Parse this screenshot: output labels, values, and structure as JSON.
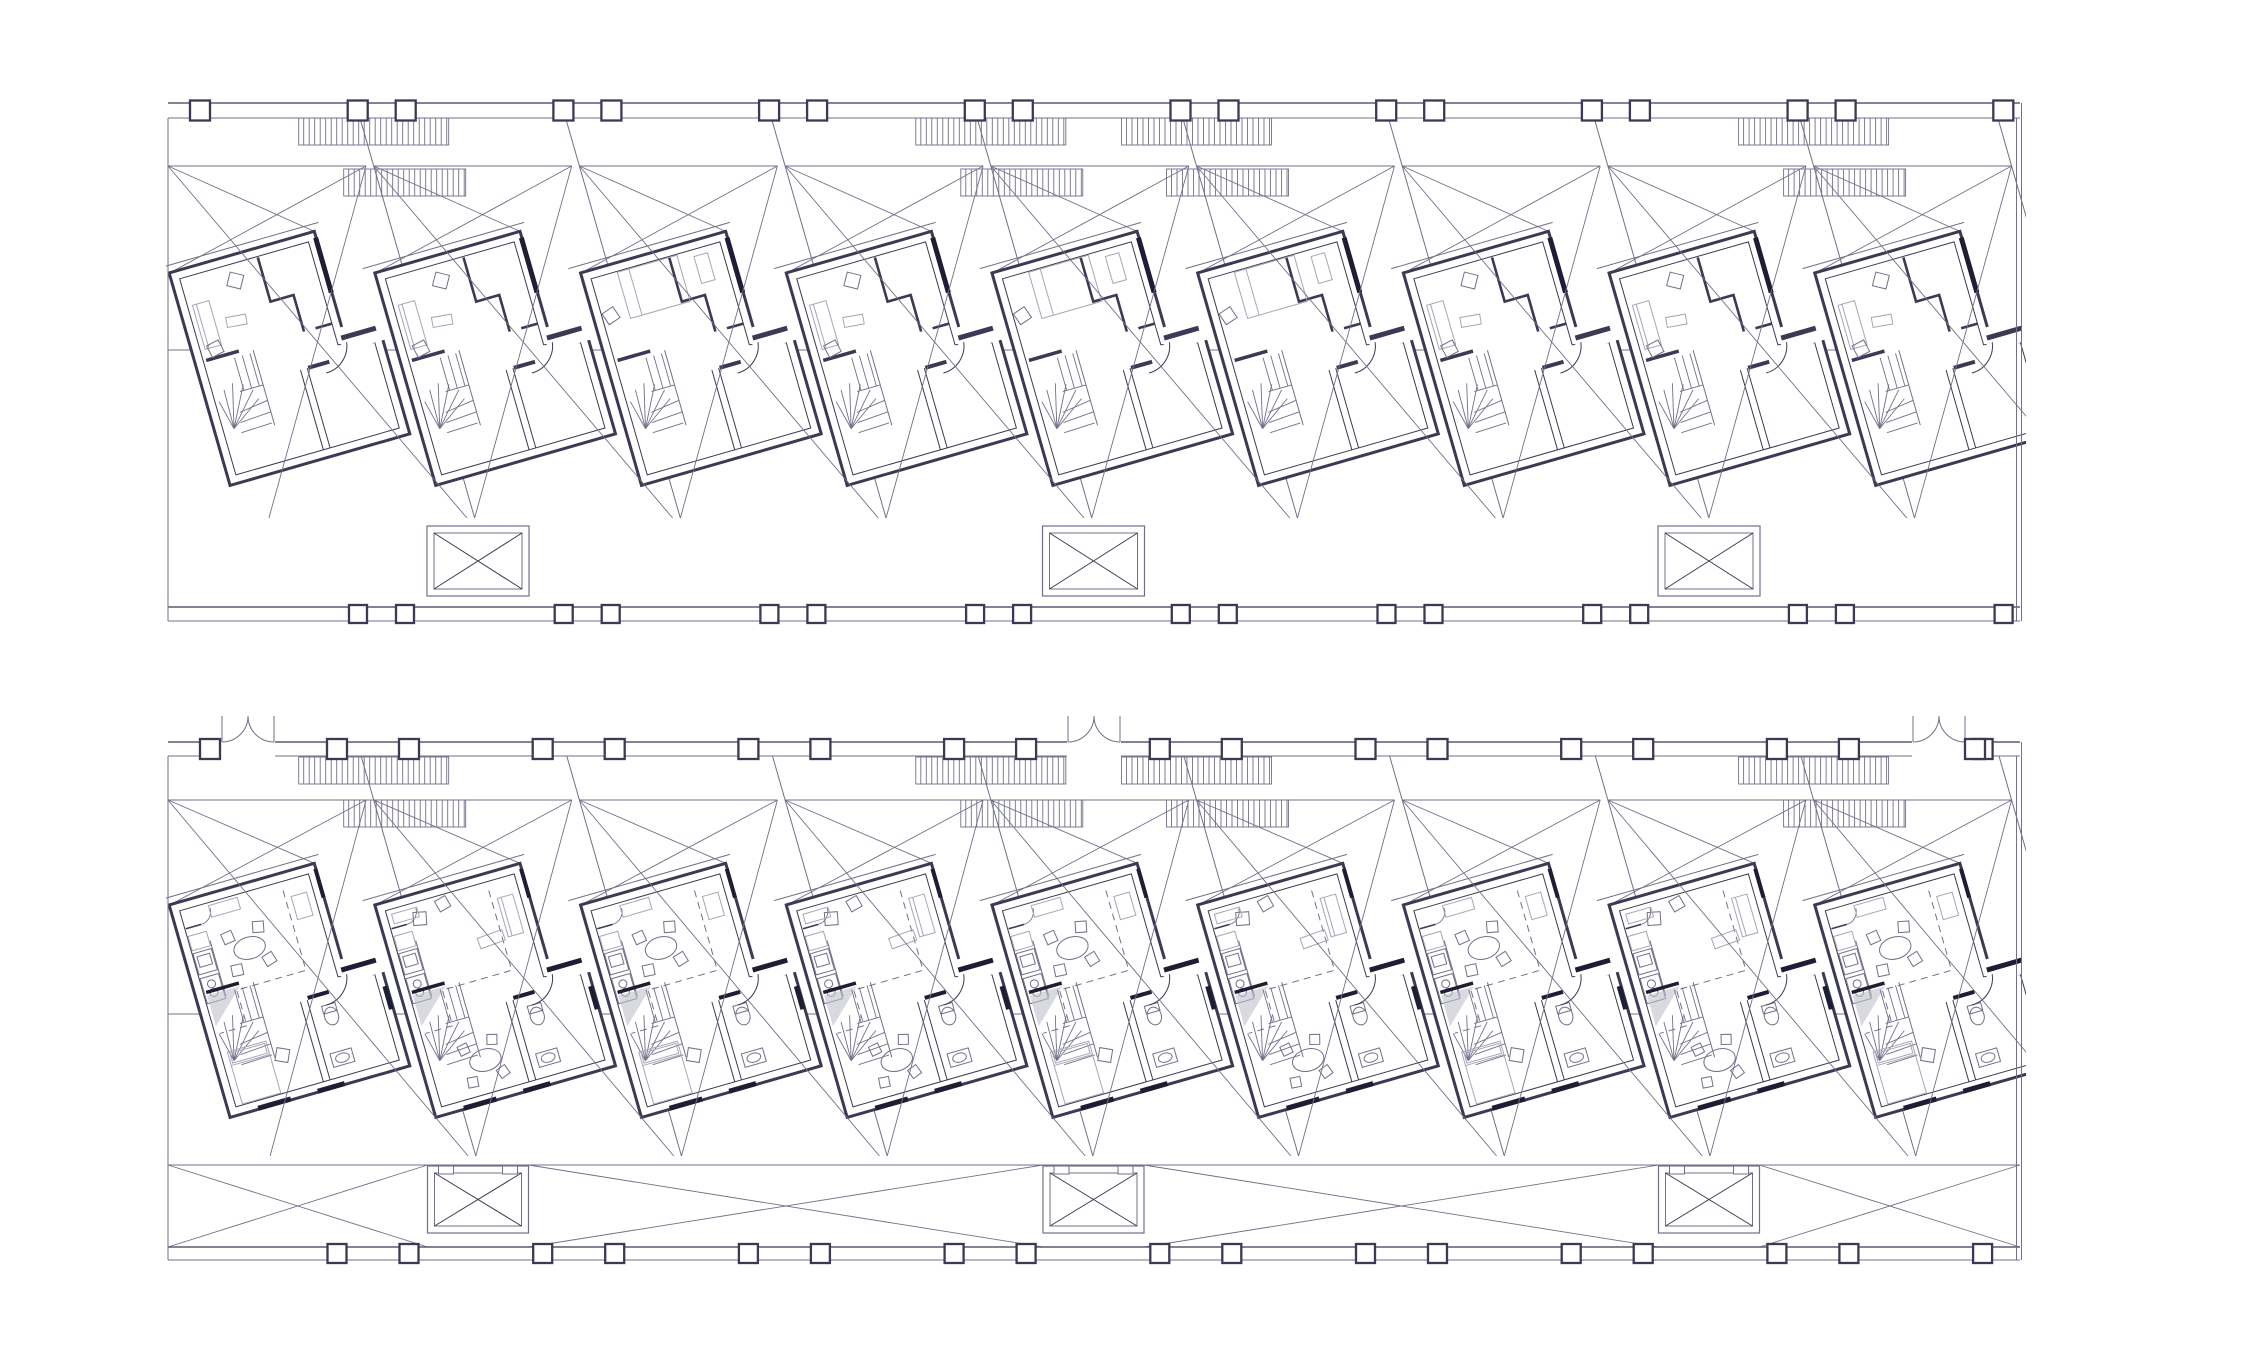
{
  "meta": {
    "title": "Row housing floor plans, two stacked level drawings",
    "drawing_type": "architectural line drawing",
    "floors": [
      {
        "id": "upper-level",
        "units": 9,
        "position": "top strip"
      },
      {
        "id": "entry-level",
        "units": 9,
        "position": "bottom strip"
      }
    ]
  },
  "palette": {
    "background": "#ffffff",
    "ink": "#3a3a54",
    "wall_edge": "#5a5a74",
    "mid": "#70708a",
    "light": "#a6a6b8",
    "dark": "#1d1d33",
    "shade": "#bfbfcc"
  },
  "unit": {
    "width": 150,
    "height": 218,
    "wing_x": 184,
    "tilt_deg": -16,
    "pitch": 205.7,
    "count": 9,
    "outline": {
      "outer": [
        -1.5,
        -1.5,
        149.5,
        -1.5,
        149.5,
        108,
        185.5,
        116,
        185.5,
        219.5,
        -1.5,
        219.5
      ],
      "inner": [
        7,
        7,
        141,
        7,
        141,
        114,
        177,
        122,
        177,
        211,
        7,
        211
      ],
      "eave": [
        -12,
        -9,
        156,
        -9
      ]
    },
    "upper_common": [
      [
        "rect",
        144,
        98,
        46,
        24,
        "whitef"
      ],
      [
        "rect",
        146,
        106,
        36,
        5,
        "inkf"
      ],
      [
        "line",
        149,
        5,
        149,
        62,
        "dark5"
      ],
      [
        "path",
        "M88,8 L88,54 L112,54 L112,92",
        "ink25"
      ],
      [
        "line",
        141,
        92,
        124,
        92,
        "ink25"
      ],
      [
        "rect",
        10,
        91,
        34,
        3.5,
        "inkf"
      ],
      [
        "stair",
        10,
        96,
        "upper"
      ],
      [
        "line",
        98,
        211,
        98,
        128,
        "ink1"
      ],
      [
        "line",
        105,
        211,
        105,
        128,
        "ink1"
      ],
      [
        "rect",
        106,
        126,
        22,
        4,
        "inkf"
      ],
      [
        "path",
        "M150,114 A28 28 0 0 1 122,138",
        "ink1"
      ]
    ],
    "lower_common": [
      [
        "rect",
        144,
        98,
        46,
        24,
        "whitef"
      ],
      [
        "rect",
        146,
        106,
        36,
        5,
        "darkf"
      ],
      [
        "line",
        149,
        4,
        149,
        34,
        "dark4"
      ],
      [
        "line",
        8,
        26,
        24,
        26,
        "ink15"
      ],
      [
        "path",
        "M24,26 A13 13 0 0 0 37,13",
        "mid09"
      ],
      [
        "line",
        28,
        44,
        28,
        102,
        "mid1"
      ],
      [
        "rect",
        8,
        34,
        19,
        15,
        "light1"
      ],
      [
        "rect",
        8,
        52,
        19,
        22,
        "mid1"
      ],
      [
        "rect",
        11,
        56,
        13,
        11,
        "mid1"
      ],
      [
        "rect",
        8,
        78,
        19,
        26,
        "mid1"
      ],
      [
        "circle",
        17.5,
        86,
        4,
        "mid1"
      ],
      [
        "circle",
        17.5,
        95,
        4,
        "mid1"
      ],
      [
        "path",
        "M112,16 L112,99 L40,99 L40,136 L12,136",
        "dashed"
      ],
      [
        "rect",
        10,
        91,
        34,
        3.5,
        "darkf"
      ],
      [
        "stair",
        10,
        96,
        "lower"
      ],
      [
        "line",
        98,
        211,
        98,
        128,
        "ink1"
      ],
      [
        "line",
        105,
        211,
        105,
        128,
        "ink1"
      ],
      [
        "rect",
        106,
        124,
        22,
        4,
        "darkf"
      ],
      [
        "ellipse",
        124,
        150,
        7,
        9,
        "mid1"
      ],
      [
        "rect",
        117,
        138,
        14,
        8,
        "mid1"
      ],
      [
        "rect",
        112,
        186,
        22,
        14,
        "mid1"
      ],
      [
        "ellipse",
        123,
        193,
        7,
        4.5,
        "mid1"
      ],
      [
        "path",
        "M150,114 A28 28 0 0 1 122,138",
        "ink1"
      ],
      [
        "rect",
        28,
        216,
        34,
        5,
        "darkf"
      ],
      [
        "rect",
        90,
        216,
        28,
        5,
        "darkf"
      ],
      [
        "rect",
        181,
        136,
        5,
        24,
        "darkf"
      ]
    ],
    "furniture": {
      "upper_A": [
        [
          "rect",
          12,
          36,
          17,
          46,
          "light1"
        ],
        [
          "line",
          16,
          36,
          16,
          82,
          "light1"
        ],
        [
          "rsq",
          60,
          24,
          14,
          30,
          "mid1"
        ],
        [
          "rsq",
          22,
          84,
          13,
          -12,
          "mid1"
        ],
        [
          "rrect",
          40,
          58,
          20,
          10,
          6,
          "light1"
        ]
      ],
      "upper_B": [
        [
          "rect",
          34,
          8,
          62,
          48,
          "light1"
        ],
        [
          "line",
          46,
          8,
          46,
          56,
          "light1"
        ],
        [
          "rsq",
          16,
          48,
          13,
          -18,
          "mid1"
        ],
        [
          "rect",
          112,
          14,
          14,
          28,
          "light1"
        ]
      ],
      "lower_A": [
        [
          "ellipse",
          64,
          62,
          16,
          11,
          "mid1"
        ],
        [
          "rsq",
          46,
          46,
          11,
          -8,
          "mid1"
        ],
        [
          "rsq",
          78,
          44,
          11,
          12,
          "mid1"
        ],
        [
          "rsq",
          46,
          80,
          11,
          4,
          "mid1"
        ],
        [
          "rsq",
          80,
          78,
          11,
          -16,
          "mid1"
        ],
        [
          "rect",
          36,
          10,
          30,
          12,
          "light1"
        ],
        [
          "rect",
          118,
          24,
          16,
          24,
          "light1"
        ],
        [
          "rect",
          14,
          156,
          40,
          54,
          "light1"
        ],
        [
          "line",
          14,
          170,
          54,
          170,
          "light1"
        ],
        [
          "rect",
          16,
          158,
          36,
          10,
          "light1"
        ],
        [
          "rsq",
          66,
          174,
          13,
          25,
          "mid1"
        ]
      ],
      "lower_B": [
        [
          "rect",
          118,
          26,
          16,
          40,
          "light1"
        ],
        [
          "line",
          122,
          26,
          122,
          66,
          "light1"
        ],
        [
          "rrect",
          88,
          58,
          26,
          11,
          -4,
          "light1"
        ],
        [
          "rsq",
          38,
          24,
          13,
          12,
          "mid1"
        ],
        [
          "rsq",
          64,
          16,
          12,
          -14,
          "mid1"
        ],
        [
          "rect",
          12,
          12,
          26,
          10,
          "light1"
        ],
        [
          "ellipse",
          62,
          178,
          16,
          11,
          "mid1"
        ],
        [
          "rsq",
          44,
          162,
          10,
          -10,
          "mid1"
        ],
        [
          "rsq",
          74,
          160,
          10,
          15,
          "mid1"
        ],
        [
          "rsq",
          44,
          196,
          10,
          5,
          "mid1"
        ],
        [
          "rsq",
          76,
          194,
          10,
          -20,
          "mid1"
        ]
      ]
    }
  },
  "strips": [
    {
      "name": "upper-level-strip",
      "floor": "upper",
      "x1": 168,
      "x2": 2020,
      "clip_y": [
        90,
        668
      ],
      "wall_top": [
        103,
        118
      ],
      "wall_bottom": [
        607,
        621
      ],
      "right_wall_double": true,
      "mid_line_y": 350,
      "lot": {
        "y": 166,
        "h": 352,
        "w": 198
      },
      "apartment_origin": {
        "x": 171,
        "y": 274
      },
      "cols_top": {
        "start": 176,
        "gap": 48,
        "size": 20,
        "count": 10,
        "extras": []
      },
      "cols_bottom": {
        "start": 381.5,
        "gap": 47,
        "size": 18,
        "count": 9,
        "extras": []
      },
      "hatch_units": [
        2,
        5,
        6,
        9
      ],
      "walkway_hatch_y": [
        118,
        145
      ],
      "lot_hatch_y": [
        169,
        196
      ],
      "shafts": {
        "cx": [
          478,
          1093.5,
          1709
        ],
        "y": 526,
        "w": 102,
        "h": 70,
        "notched": false
      },
      "doors": null,
      "band": null,
      "variants": [
        "A",
        "A",
        "B",
        "A",
        "B",
        "B",
        "A",
        "A",
        "A"
      ]
    },
    {
      "name": "entry-level-strip",
      "floor": "lower",
      "x1": 168,
      "x2": 2020,
      "clip_y": [
        695,
        1275
      ],
      "wall_top": [
        742,
        756
      ],
      "wall_bottom": [
        1247,
        1260
      ],
      "right_wall_double": true,
      "mid_line_y": 1014,
      "lot": {
        "y": 800,
        "h": 356,
        "w": 198
      },
      "apartment_origin": {
        "x": 171,
        "y": 906
      },
      "cols_top": {
        "start": 373,
        "gap": 72,
        "size": 20,
        "count": 9,
        "extras": [
          210,
          1975
        ]
      },
      "cols_bottom": {
        "start": 373,
        "gap": 72,
        "size": 19,
        "count": 9,
        "extras": []
      },
      "hatch_units": [
        2,
        5,
        6,
        9
      ],
      "walkway_hatch_y": [
        757,
        784
      ],
      "lot_hatch_y": [
        800,
        827
      ],
      "shafts": {
        "cx": [
          478,
          1093.5,
          1709
        ],
        "y": 1166,
        "w": 101,
        "h": 67,
        "notched": true
      },
      "doors": {
        "centers": [
          248,
          1094,
          1939
        ],
        "half": 26,
        "rise": 26
      },
      "band": {
        "top_y": 1165,
        "bottom_y": 1247
      },
      "variants": [
        "A",
        "B",
        "A",
        "B",
        "A",
        "B",
        "A",
        "B",
        "A"
      ]
    }
  ]
}
